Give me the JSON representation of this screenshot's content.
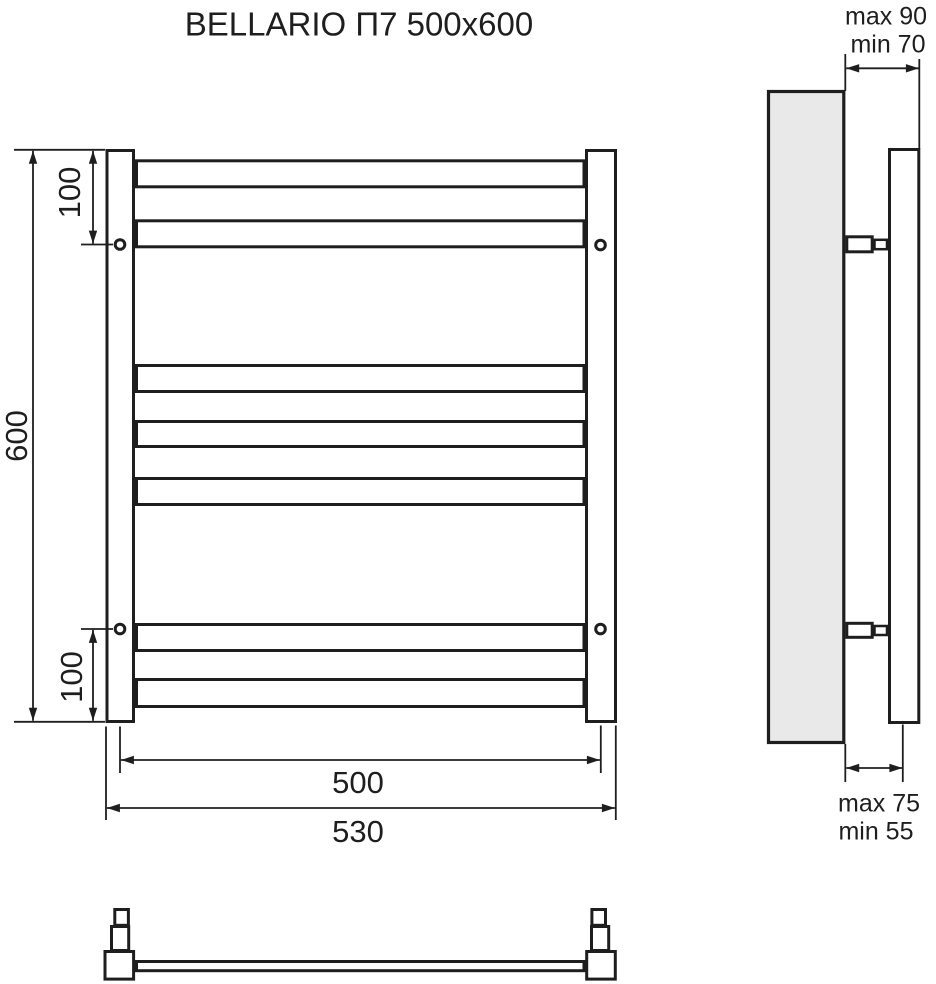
{
  "title": "BELLARIO П7 500x600",
  "front_view": {
    "height_label": "600",
    "top_bracket_offset_label": "100",
    "bottom_bracket_offset_label": "100",
    "bar_span_label": "500",
    "overall_width_label": "530",
    "bar_count": 7
  },
  "side_view": {
    "wall_clearance_top": {
      "max": "max 90",
      "min": "min 70"
    },
    "wall_clearance_bottom": {
      "max": "max 75",
      "min": "min 55"
    }
  },
  "colors": {
    "line": "#1e1e1e",
    "wall_fill": "#e9e9e9",
    "background": "#ffffff"
  }
}
